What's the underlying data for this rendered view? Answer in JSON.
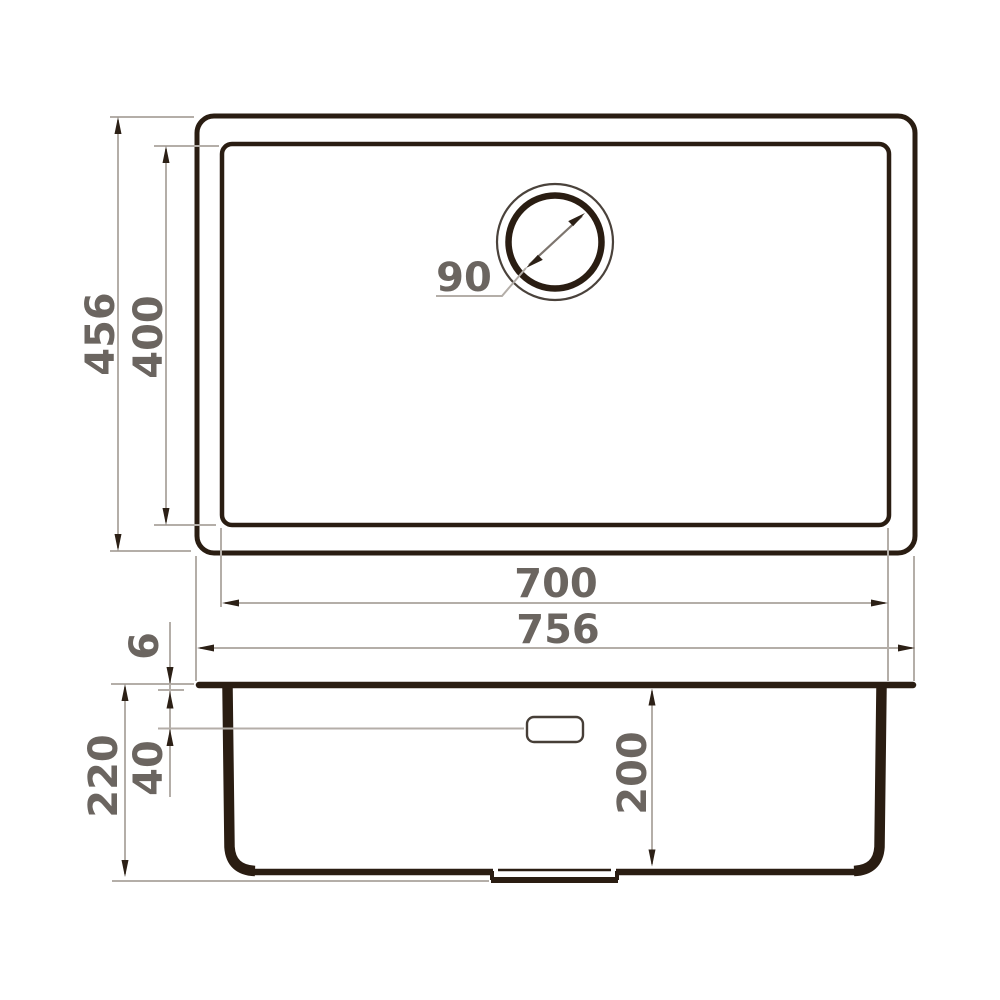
{
  "drawing": {
    "type": "sink-dimension-diagram",
    "views": [
      "top-view",
      "side-section-view"
    ],
    "top_view": {
      "outer_depth": "456",
      "inner_depth": "400",
      "drain_diameter": "90",
      "inner_width": "700",
      "outer_width": "756"
    },
    "side_view": {
      "rim_thickness": "6",
      "overflow_offset": "40",
      "overall_height": "220",
      "bowl_depth": "200"
    },
    "colors": {
      "outline_dark": "#2a1d12",
      "outline_soft": "#4a423b",
      "dimension_line": "#b4aea8",
      "arrowhead": "#2c2016",
      "label_text": "#6b6560",
      "background": "#ffffff"
    }
  }
}
